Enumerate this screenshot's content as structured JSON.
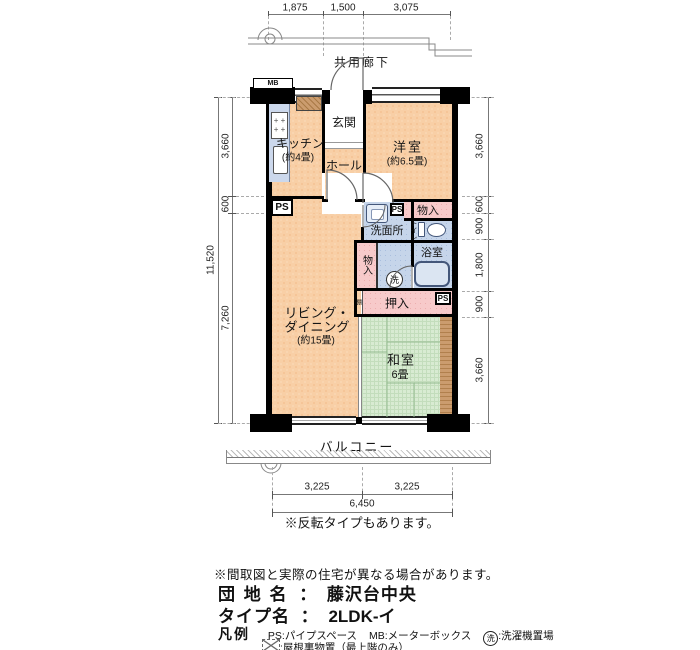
{
  "dims": {
    "top": [
      "1,875",
      "1,500",
      "3,075"
    ],
    "left_outer": "11,520",
    "left": [
      "3,660",
      "600",
      "7,260"
    ],
    "right": [
      "3,660",
      "600",
      "900",
      "1,800",
      "900",
      "3,660"
    ],
    "bottom": [
      "3,225",
      "3,225"
    ],
    "bottom_total": "6,450"
  },
  "labels": {
    "corridor": "共用廊下",
    "balcony": "バルコニー",
    "entrance": "玄関",
    "hall": "ホール",
    "kitchen": "キッチン",
    "kitchen_size": "(約4畳)",
    "western_room": "洋室",
    "western_room_size": "(約6.5畳)",
    "living1": "リビング・",
    "living2": "ダイニング",
    "living_size": "(約15畳)",
    "washroom": "洗面所",
    "toilet": "トイレ",
    "bath": "浴室",
    "storage_top": "物入",
    "storage_left": "物入",
    "oshiire": "押入",
    "shelf": "棚",
    "washer": "洗",
    "japanese_room": "和室",
    "japanese_room_size": "6畳",
    "ps": "PS",
    "mb": "MB"
  },
  "notes": {
    "reverse": "※反転タイプもあります。",
    "disclaimer": "※間取図と実際の住宅が異なる場合があります。"
  },
  "info": {
    "estate_label": "団 地 名",
    "estate_sep": "：",
    "estate_name": "藤沢台中央",
    "type_label": "タイプ名",
    "type_sep": "：",
    "type_name": "2LDK-イ"
  },
  "legend": {
    "title": "凡例",
    "ps": "PS:パイプスペース",
    "mb": "MB:メーターボックス",
    "washer_symbol": "洗",
    "washer_text": ":洗濯機置場",
    "attic_text": ":屋根裏物置（最上階のみ）"
  },
  "colors": {
    "room": "#f8cfa6",
    "wet_area": "#c6d5ea",
    "closet": "#f7caca",
    "tatami": "#d8ebd2",
    "wood": "#cb9c6e",
    "wall": "#000000"
  }
}
